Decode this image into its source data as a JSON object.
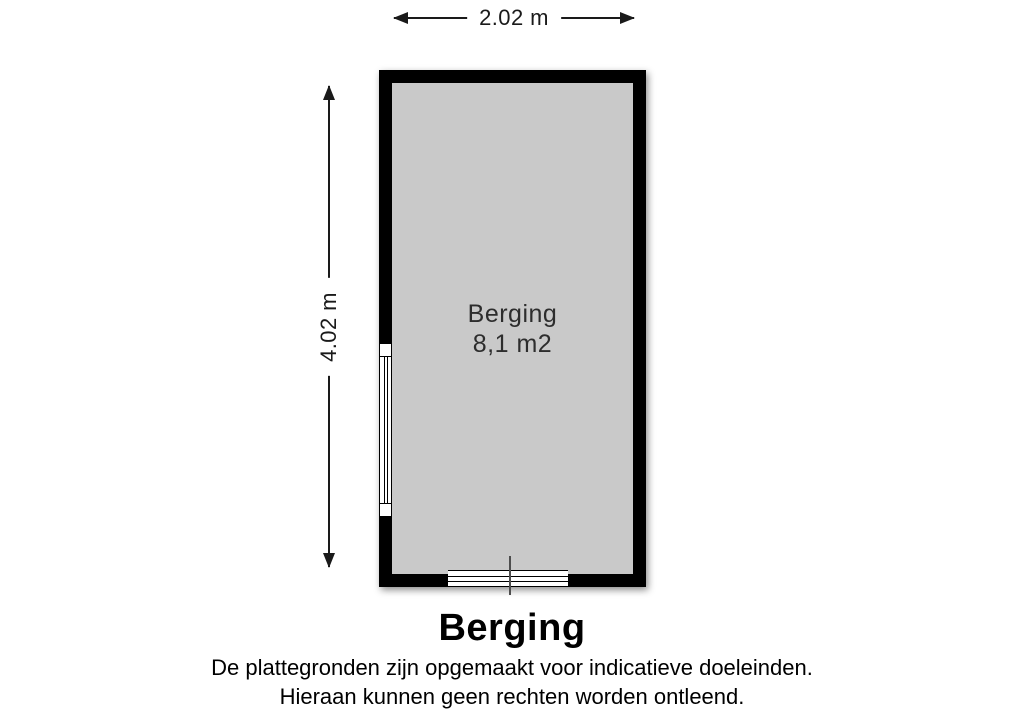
{
  "dimensions": {
    "width_label": "2.02 m",
    "height_label": "4.02 m"
  },
  "room": {
    "name": "Berging",
    "area": "8,1 m2"
  },
  "caption": {
    "title": "Berging",
    "disclaimer_line1": "De plattegronden zijn opgemaakt voor indicatieve doeleinden.",
    "disclaimer_line2": "Hieraan kunnen geen rechten worden ontleend."
  },
  "colors": {
    "wall": "#000000",
    "floor": "#c9c9c9",
    "dimension": "#1a1a1a",
    "room_text": "#2d2d2d",
    "door_mark": "#4d4d4d",
    "caption_text": "#000000"
  }
}
